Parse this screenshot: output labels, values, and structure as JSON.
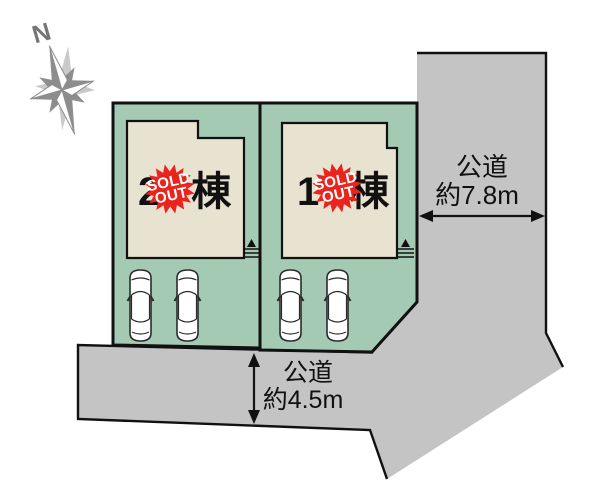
{
  "compass": {
    "label": "N"
  },
  "plots": [
    {
      "label": "2棟",
      "badge_line1": "SOLD",
      "badge_line2": "OUT"
    },
    {
      "label": "1棟",
      "badge_line1": "SOLD",
      "badge_line2": "OUT"
    }
  ],
  "roads": [
    {
      "position": "east",
      "name": "公道",
      "width": "約7.8m"
    },
    {
      "position": "south",
      "name": "公道",
      "width": "約4.5m"
    }
  ],
  "colors": {
    "road_gray": "#c4c4c4",
    "plot_green": "#a5cab4",
    "building_beige": "#e8e2d1",
    "badge_red": "#ea231c",
    "line_black": "#111111",
    "compass_gray": "#8d8d8d",
    "compass_light": "#c9c9c9"
  }
}
